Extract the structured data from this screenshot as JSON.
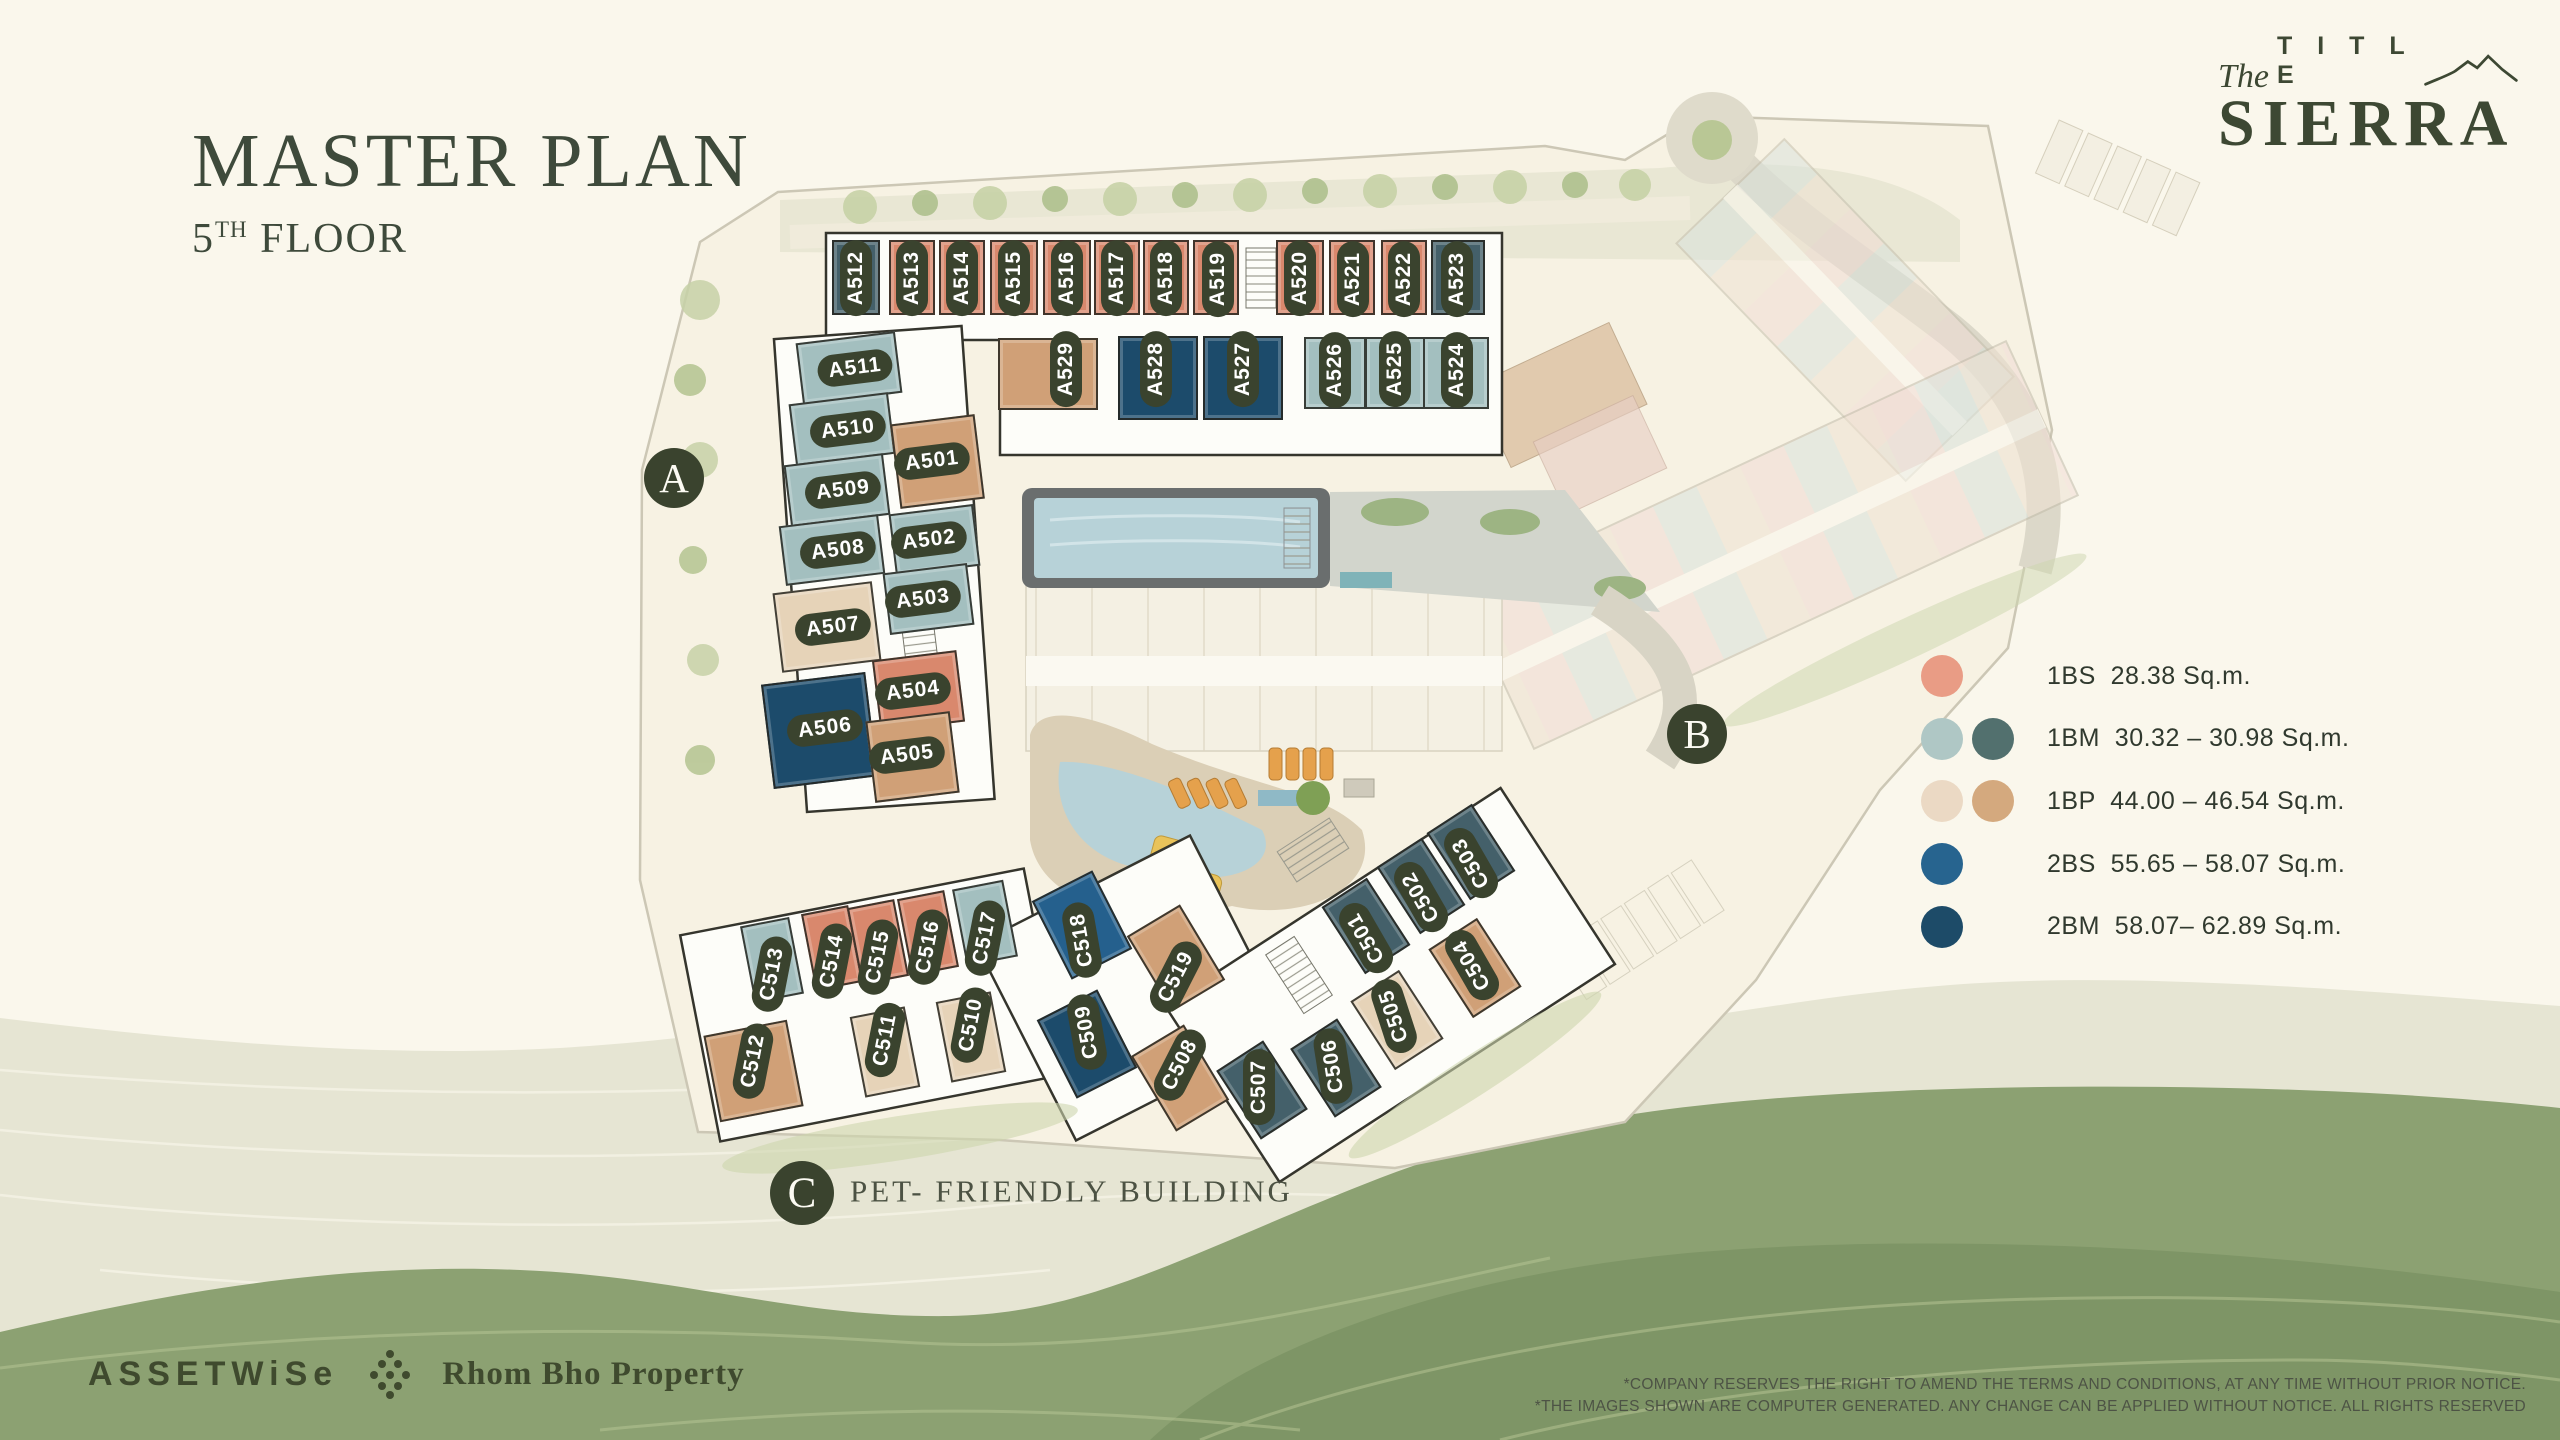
{
  "title": {
    "main": "MASTER PLAN",
    "floor_number": "5",
    "floor_sup": "TH",
    "floor_word": " FLOOR"
  },
  "brand": {
    "pre": "The",
    "word": "T I T L E",
    "name": "SIERRA",
    "accent": "#3d4833"
  },
  "legend": {
    "items": [
      {
        "code": "1BS",
        "size": "28.38 Sq.m.",
        "swatches": [
          "#E99C85"
        ]
      },
      {
        "code": "1BM",
        "size": "30.32 – 30.98 Sq.m.",
        "swatches": [
          "#AFC7C5",
          "#52706E"
        ]
      },
      {
        "code": "1BP",
        "size": "44.00 – 46.54 Sq.m.",
        "swatches": [
          "#EBD9C4",
          "#D4A97E"
        ]
      },
      {
        "code": "2BS",
        "size": "55.65 – 58.07 Sq.m.",
        "swatches": [
          "#27648F"
        ]
      },
      {
        "code": "2BM",
        "size": "58.07– 62.89 Sq.m.",
        "swatches": [
          "#1D4B68"
        ]
      }
    ]
  },
  "markers": [
    {
      "label": "A",
      "x": 674,
      "y": 478,
      "r": 30
    },
    {
      "label": "B",
      "x": 1697,
      "y": 734,
      "r": 30
    },
    {
      "label": "C",
      "x": 802,
      "y": 1193,
      "r": 32
    }
  ],
  "pet_note": "PET- FRIENDLY BUILDING",
  "unit_colors": {
    "1BS": "#D9886D",
    "1BM-L": "#A3BFBF",
    "1BM-D": "#44606A",
    "1BP-L": "#E6D3B8",
    "1BP-D": "#D0A077",
    "2BS": "#25608D",
    "2BM": "#1C4B6B"
  },
  "pill_color": "#3a432e",
  "units": [
    {
      "id": "A512",
      "type": "1BM-D",
      "x": 856,
      "y": 277,
      "w": 48,
      "h": 75,
      "rot": 0,
      "lx": 856,
      "ly": 278,
      "lrot": -90
    },
    {
      "id": "A513",
      "type": "1BS",
      "x": 912,
      "y": 277,
      "w": 46,
      "h": 75,
      "rot": 0,
      "lx": 912,
      "ly": 278,
      "lrot": -90
    },
    {
      "id": "A514",
      "type": "1BS",
      "x": 962,
      "y": 277,
      "w": 46,
      "h": 75,
      "rot": 0,
      "lx": 962,
      "ly": 278,
      "lrot": -90
    },
    {
      "id": "A515",
      "type": "1BS",
      "x": 1014,
      "y": 277,
      "w": 48,
      "h": 75,
      "rot": 0,
      "lx": 1014,
      "ly": 278,
      "lrot": -90
    },
    {
      "id": "A516",
      "type": "1BS",
      "x": 1067,
      "y": 277,
      "w": 48,
      "h": 75,
      "rot": 0,
      "lx": 1067,
      "ly": 278,
      "lrot": -90
    },
    {
      "id": "A517",
      "type": "1BS",
      "x": 1117,
      "y": 277,
      "w": 46,
      "h": 75,
      "rot": 0,
      "lx": 1117,
      "ly": 278,
      "lrot": -90
    },
    {
      "id": "A518",
      "type": "1BS",
      "x": 1166,
      "y": 277,
      "w": 46,
      "h": 75,
      "rot": 0,
      "lx": 1166,
      "ly": 278,
      "lrot": -90
    },
    {
      "id": "A519",
      "type": "1BS",
      "x": 1216,
      "y": 277,
      "w": 46,
      "h": 75,
      "rot": 0,
      "lx": 1218,
      "ly": 279,
      "lrot": -90
    },
    {
      "id": "A520",
      "type": "1BS",
      "x": 1300,
      "y": 277,
      "w": 48,
      "h": 75,
      "rot": 0,
      "lx": 1300,
      "ly": 278,
      "lrot": -90
    },
    {
      "id": "A521",
      "type": "1BS",
      "x": 1352,
      "y": 277,
      "w": 46,
      "h": 75,
      "rot": 0,
      "lx": 1353,
      "ly": 279,
      "lrot": -90
    },
    {
      "id": "A522",
      "type": "1BS",
      "x": 1404,
      "y": 277,
      "w": 46,
      "h": 75,
      "rot": 0,
      "lx": 1404,
      "ly": 279,
      "lrot": -90
    },
    {
      "id": "A523",
      "type": "1BM-D",
      "x": 1458,
      "y": 277,
      "w": 54,
      "h": 75,
      "rot": 0,
      "lx": 1457,
      "ly": 279,
      "lrot": -90
    },
    {
      "id": "A529",
      "type": "1BP-D",
      "x": 1048,
      "y": 374,
      "w": 100,
      "h": 72,
      "rot": 0,
      "lx": 1066,
      "ly": 369,
      "lrot": -90
    },
    {
      "id": "A528",
      "type": "2BM",
      "x": 1158,
      "y": 378,
      "w": 80,
      "h": 84,
      "rot": 0,
      "lx": 1156,
      "ly": 369,
      "lrot": -90
    },
    {
      "id": "A527",
      "type": "2BM",
      "x": 1243,
      "y": 378,
      "w": 80,
      "h": 84,
      "rot": 0,
      "lx": 1243,
      "ly": 369,
      "lrot": -90
    },
    {
      "id": "A526",
      "type": "1BM-L",
      "x": 1335,
      "y": 373,
      "w": 62,
      "h": 72,
      "rot": 0,
      "lx": 1335,
      "ly": 370,
      "lrot": -90
    },
    {
      "id": "A525",
      "type": "1BM-L",
      "x": 1395,
      "y": 373,
      "w": 60,
      "h": 72,
      "rot": 0,
      "lx": 1395,
      "ly": 369,
      "lrot": -90
    },
    {
      "id": "A524",
      "type": "1BM-L",
      "x": 1456,
      "y": 373,
      "w": 66,
      "h": 72,
      "rot": 0,
      "lx": 1457,
      "ly": 370,
      "lrot": -90
    },
    {
      "id": "A511",
      "type": "1BM-L",
      "x": 849,
      "y": 368,
      "w": 100,
      "h": 62,
      "rot": -7,
      "lx": 855,
      "ly": 368,
      "lrot": -7
    },
    {
      "id": "A510",
      "type": "1BM-L",
      "x": 842,
      "y": 429,
      "w": 100,
      "h": 62,
      "rot": -7,
      "lx": 848,
      "ly": 429,
      "lrot": -7
    },
    {
      "id": "A509",
      "type": "1BM-L",
      "x": 837,
      "y": 490,
      "w": 100,
      "h": 62,
      "rot": -7,
      "lx": 843,
      "ly": 490,
      "lrot": -7
    },
    {
      "id": "A508",
      "type": "1BM-L",
      "x": 832,
      "y": 550,
      "w": 100,
      "h": 60,
      "rot": -7,
      "lx": 838,
      "ly": 550,
      "lrot": -7
    },
    {
      "id": "A507",
      "type": "1BP-L",
      "x": 827,
      "y": 627,
      "w": 100,
      "h": 80,
      "rot": -7,
      "lx": 833,
      "ly": 627,
      "lrot": -7
    },
    {
      "id": "A506",
      "type": "2BM",
      "x": 819,
      "y": 730,
      "w": 105,
      "h": 105,
      "rot": -7,
      "lx": 825,
      "ly": 728,
      "lrot": -7
    },
    {
      "id": "A501",
      "type": "1BP-D",
      "x": 937,
      "y": 461,
      "w": 85,
      "h": 85,
      "rot": -7,
      "lx": 932,
      "ly": 461,
      "lrot": -7
    },
    {
      "id": "A502",
      "type": "1BM-L",
      "x": 934,
      "y": 540,
      "w": 85,
      "h": 62,
      "rot": -7,
      "lx": 929,
      "ly": 540,
      "lrot": -7
    },
    {
      "id": "A503",
      "type": "1BM-L",
      "x": 928,
      "y": 599,
      "w": 85,
      "h": 62,
      "rot": -7,
      "lx": 923,
      "ly": 599,
      "lrot": -7
    },
    {
      "id": "A504",
      "type": "1BS",
      "x": 918,
      "y": 691,
      "w": 85,
      "h": 72,
      "rot": -7,
      "lx": 913,
      "ly": 691,
      "lrot": -7
    },
    {
      "id": "A505",
      "type": "1BP-D",
      "x": 912,
      "y": 757,
      "w": 85,
      "h": 82,
      "rot": -7,
      "lx": 907,
      "ly": 755,
      "lrot": -7
    },
    {
      "id": "C513",
      "type": "1BM-L",
      "x": 772,
      "y": 960,
      "w": 50,
      "h": 78,
      "rot": -11,
      "lx": 772,
      "ly": 974,
      "lrot": -79
    },
    {
      "id": "C514",
      "type": "1BS",
      "x": 832,
      "y": 948,
      "w": 48,
      "h": 78,
      "rot": -11,
      "lx": 832,
      "ly": 961,
      "lrot": -79
    },
    {
      "id": "C515",
      "type": "1BS",
      "x": 878,
      "y": 942,
      "w": 48,
      "h": 78,
      "rot": -11,
      "lx": 878,
      "ly": 957,
      "lrot": -79
    },
    {
      "id": "C516",
      "type": "1BS",
      "x": 928,
      "y": 933,
      "w": 48,
      "h": 78,
      "rot": -11,
      "lx": 928,
      "ly": 947,
      "lrot": -79
    },
    {
      "id": "C517",
      "type": "1BM-L",
      "x": 985,
      "y": 923,
      "w": 52,
      "h": 78,
      "rot": -11,
      "lx": 985,
      "ly": 938,
      "lrot": -79
    },
    {
      "id": "C518",
      "type": "2BS",
      "x": 1082,
      "y": 925,
      "w": 68,
      "h": 88,
      "rot": -27,
      "lx": 1082,
      "ly": 940,
      "lrot": -100
    },
    {
      "id": "C519",
      "type": "1BP-D",
      "x": 1176,
      "y": 958,
      "w": 62,
      "h": 88,
      "rot": -31,
      "lx": 1176,
      "ly": 977,
      "lrot": -63
    },
    {
      "id": "C512",
      "type": "1BP-D",
      "x": 753,
      "y": 1071,
      "w": 85,
      "h": 88,
      "rot": -11,
      "lx": 753,
      "ly": 1061,
      "lrot": -79
    },
    {
      "id": "C511",
      "type": "1BP-L",
      "x": 885,
      "y": 1052,
      "w": 56,
      "h": 82,
      "rot": -11,
      "lx": 885,
      "ly": 1040,
      "lrot": -79
    },
    {
      "id": "C510",
      "type": "1BP-L",
      "x": 971,
      "y": 1037,
      "w": 56,
      "h": 82,
      "rot": -11,
      "lx": 971,
      "ly": 1025,
      "lrot": -79
    },
    {
      "id": "C509",
      "type": "2BM",
      "x": 1087,
      "y": 1044,
      "w": 68,
      "h": 88,
      "rot": -27,
      "lx": 1087,
      "ly": 1032,
      "lrot": -100
    },
    {
      "id": "C508",
      "type": "1BP-D",
      "x": 1180,
      "y": 1078,
      "w": 62,
      "h": 88,
      "rot": -31,
      "lx": 1180,
      "ly": 1065,
      "lrot": -63
    },
    {
      "id": "C501",
      "type": "1BM-D",
      "x": 1366,
      "y": 926,
      "w": 54,
      "h": 80,
      "rot": -33,
      "lx": 1366,
      "ly": 938,
      "lrot": -120
    },
    {
      "id": "C502",
      "type": "1BM-D",
      "x": 1421,
      "y": 886,
      "w": 54,
      "h": 80,
      "rot": -33,
      "lx": 1421,
      "ly": 897,
      "lrot": -120
    },
    {
      "id": "C503",
      "type": "1BM-D",
      "x": 1471,
      "y": 852,
      "w": 54,
      "h": 80,
      "rot": -33,
      "lx": 1471,
      "ly": 863,
      "lrot": -120
    },
    {
      "id": "C504",
      "type": "1BP-D",
      "x": 1475,
      "y": 968,
      "w": 58,
      "h": 82,
      "rot": -33,
      "lx": 1472,
      "ly": 965,
      "lrot": -120
    },
    {
      "id": "C505",
      "type": "1BP-L",
      "x": 1397,
      "y": 1020,
      "w": 58,
      "h": 82,
      "rot": -33,
      "lx": 1394,
      "ly": 1016,
      "lrot": -108
    },
    {
      "id": "C506",
      "type": "1BM-D",
      "x": 1336,
      "y": 1068,
      "w": 56,
      "h": 82,
      "rot": -33,
      "lx": 1333,
      "ly": 1066,
      "lrot": -99
    },
    {
      "id": "C507",
      "type": "1BM-D",
      "x": 1262,
      "y": 1090,
      "w": 56,
      "h": 82,
      "rot": -33,
      "lx": 1259,
      "ly": 1087,
      "lrot": -90
    }
  ],
  "developers": {
    "assetwise": "ASSETWiSe",
    "rhombho": "Rhom Bho Property"
  },
  "disclaimer": {
    "line1": "*COMPANY RESERVES THE RIGHT TO AMEND THE TERMS AND CONDITIONS, AT ANY TIME WITHOUT PRIOR NOTICE.",
    "line2": "*THE IMAGES SHOWN ARE COMPUTER GENERATED. ANY CHANGE CAN BE APPLIED WITHOUT NOTICE. ALL RIGHTS RESERVED"
  }
}
